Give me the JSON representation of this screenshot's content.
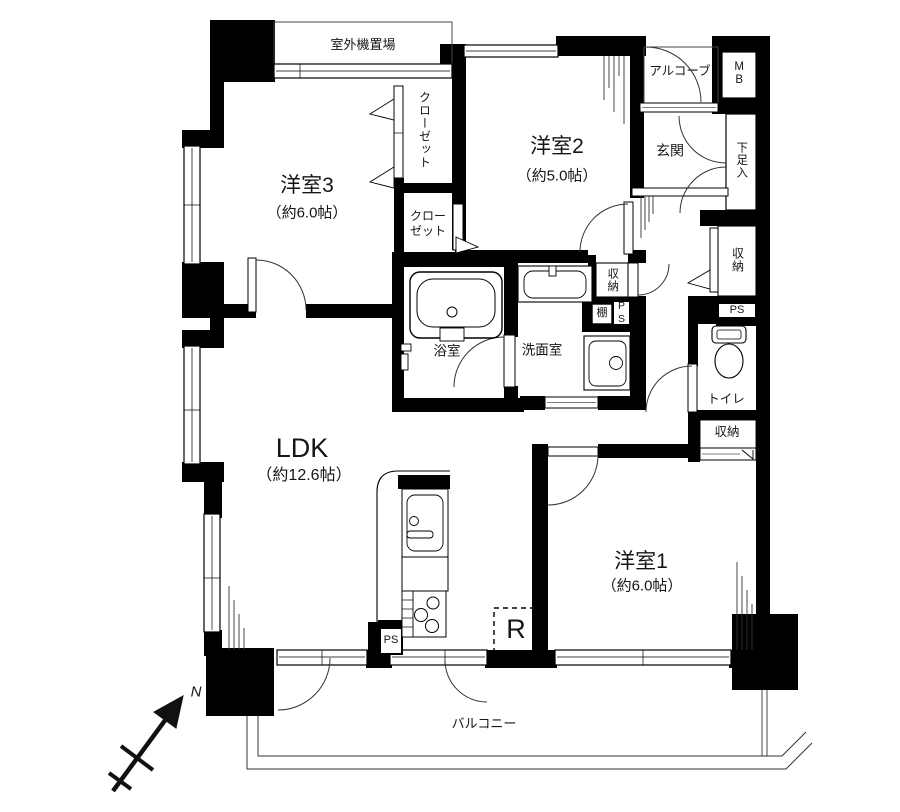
{
  "rooms": {
    "bedroom3": {
      "name": "洋室3",
      "size": "（約6.0帖）"
    },
    "bedroom2": {
      "name": "洋室2",
      "size": "（約5.0帖）"
    },
    "bedroom1": {
      "name": "洋室1",
      "size": "（約6.0帖）"
    },
    "ldk": {
      "name": "LDK",
      "size": "（約12.6帖）"
    },
    "entrance": {
      "label": "玄関"
    },
    "bath": {
      "label": "浴室"
    },
    "washroom": {
      "label": "洗面室"
    },
    "toilet": {
      "label": "トイレ"
    },
    "balcony": {
      "label": "バルコニー"
    },
    "outdoor_unit_area": {
      "label": "室外機置場"
    },
    "alcove": {
      "label": "アルコーブ"
    }
  },
  "storage": {
    "closet_tall": {
      "label": "クローゼット"
    },
    "closet_small": {
      "line1": "クロー",
      "line2": "ゼット"
    },
    "shoe_cabinet": {
      "label": "下足入"
    },
    "hall_storage_right": {
      "label": "収納"
    },
    "hall_storage_mid": {
      "label": "収納"
    },
    "bedroom1_storage": {
      "label": "収納"
    },
    "shelf": {
      "label": "棚"
    }
  },
  "utilities": {
    "meter_box": {
      "label": "MB"
    },
    "pipe_space_right": {
      "label": "PS"
    },
    "pipe_space_mid": {
      "label": "PS"
    },
    "pipe_space_kitchen": {
      "label": "PS"
    },
    "refrigerator_space": {
      "label": "R"
    }
  },
  "compass": {
    "north": "N"
  },
  "colors": {
    "wall": "#000000",
    "background": "#ffffff",
    "line": "#333333"
  }
}
